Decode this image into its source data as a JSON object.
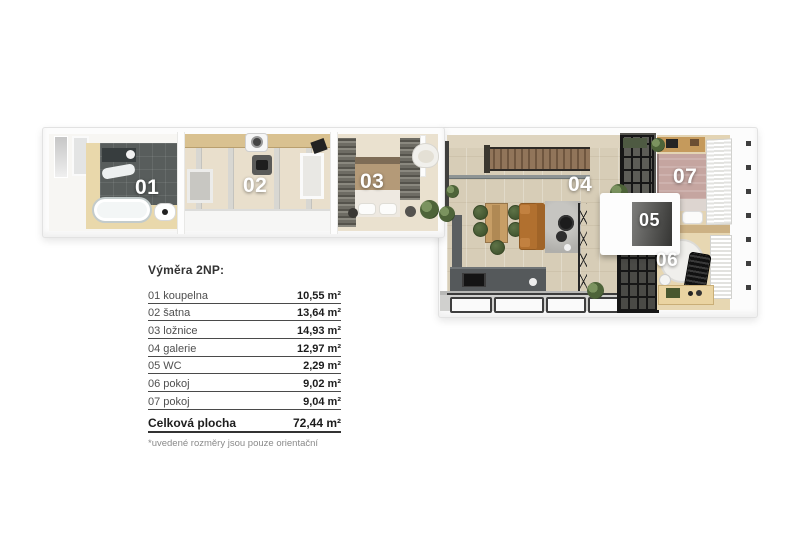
{
  "floor_plan": {
    "labels": {
      "r01": "01",
      "r02": "02",
      "r03": "03",
      "r04": "04",
      "r05": "05",
      "r06": "06",
      "r07": "07"
    }
  },
  "legend": {
    "title": "Výměra 2NP:",
    "rows": [
      {
        "label": "01 koupelna",
        "value": "10,55 m²"
      },
      {
        "label": "02 šatna",
        "value": "13,64 m²"
      },
      {
        "label": "03 ložnice",
        "value": "14,93 m²"
      },
      {
        "label": "04 galerie",
        "value": "12,97 m²"
      },
      {
        "label": "05 WC",
        "value": "2,29 m²"
      },
      {
        "label": "06 pokoj",
        "value": "9,02 m²"
      },
      {
        "label": "07 pokoj",
        "value": "9,04 m²"
      }
    ],
    "total_label": "Celková plocha",
    "total_value": "72,44 m²",
    "footnote": "*uvedené rozměry jsou pouze orientační"
  },
  "colors": {
    "floor_wood": "#d7cdb7",
    "tile_dark": "#585d5c",
    "bed_mauve": "#c5a5a0",
    "sofa_orange": "#b1702f",
    "chair_green": "#4f6440",
    "text_dark": "#3a3a3a"
  }
}
